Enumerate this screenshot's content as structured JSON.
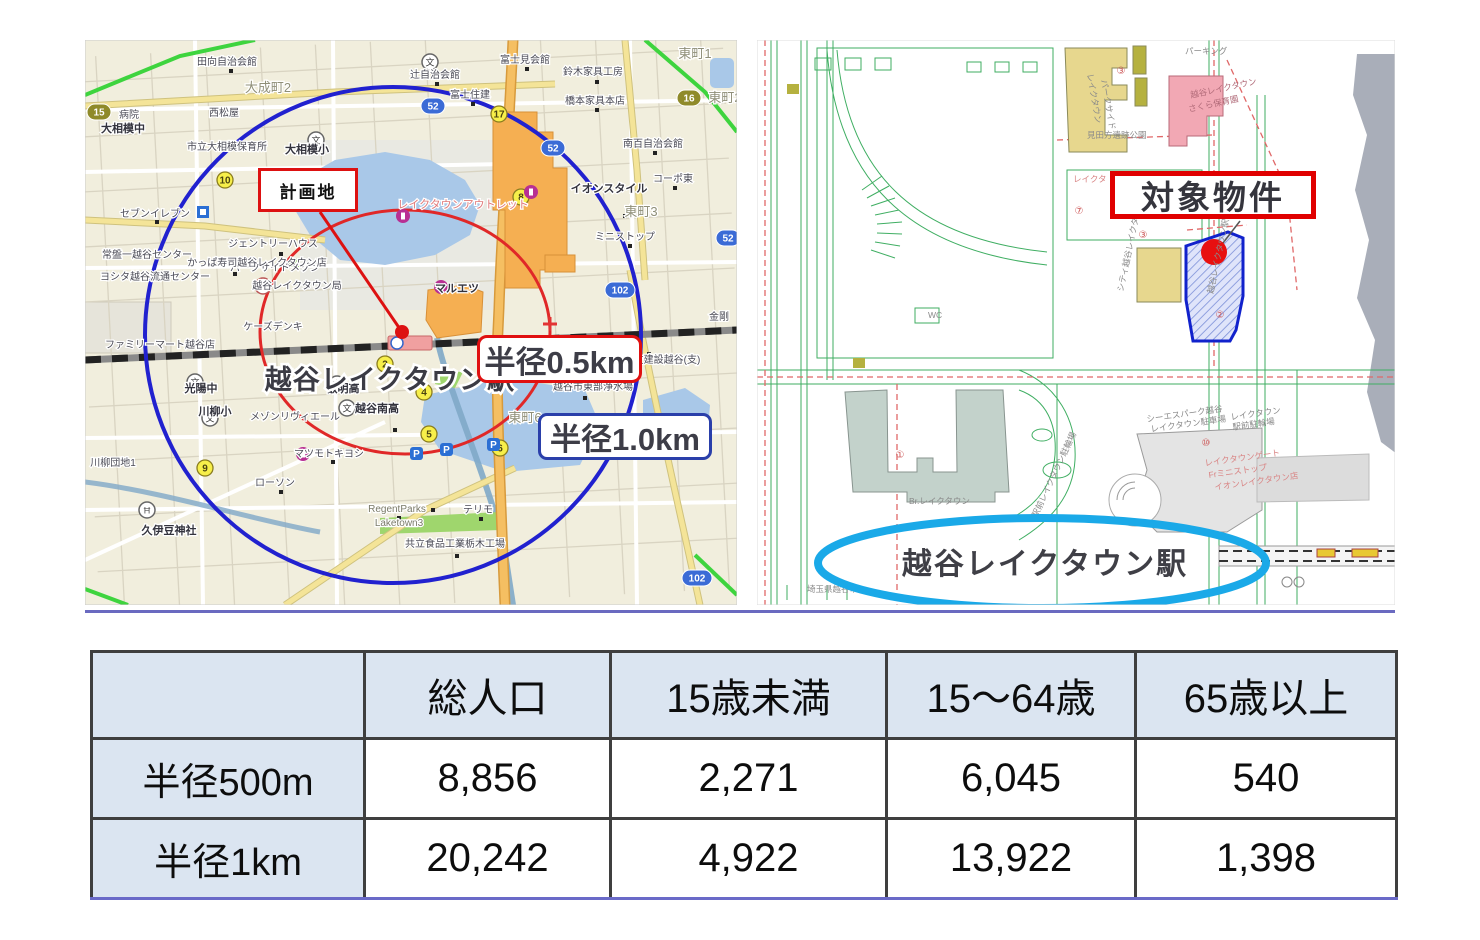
{
  "left_map": {
    "description": "radius map around planned site",
    "station_name": "越谷レイクタウン駅",
    "callouts": {
      "plan_site": "計画地",
      "radius_500m": "半径0.5km",
      "radius_1km": "半径1.0km"
    },
    "colors": {
      "circle_500m": "#e02828",
      "circle_1km": "#2121cf",
      "plan_box_border": "#dd1111",
      "radius_500m_border": "#e01010",
      "radius_1km_border": "#2a3faa",
      "map_background": "#f1eedd",
      "water": "#a9c8e8"
    },
    "labels": [
      {
        "t": "大相模中",
        "x": 38,
        "y": 92,
        "c": "m"
      },
      {
        "t": "田向自治会館",
        "x": 142,
        "y": 25,
        "c": "s"
      },
      {
        "t": "大成町2",
        "x": 183,
        "y": 52,
        "c": "area"
      },
      {
        "t": "市立大相模保育所",
        "x": 142,
        "y": 110,
        "c": "s"
      },
      {
        "t": "大相模小",
        "x": 222,
        "y": 113,
        "c": "m"
      },
      {
        "t": "西松屋",
        "x": 139,
        "y": 76,
        "c": "s"
      },
      {
        "t": "辻自治会館",
        "x": 350,
        "y": 38,
        "c": "s"
      },
      {
        "t": "富士見会館",
        "x": 440,
        "y": 23,
        "c": "s"
      },
      {
        "t": "鈴木家具工房",
        "x": 508,
        "y": 35,
        "c": "s"
      },
      {
        "t": "橋本家具本店",
        "x": 510,
        "y": 64,
        "c": "s"
      },
      {
        "t": "東町1",
        "x": 610,
        "y": 18,
        "c": "area"
      },
      {
        "t": "東町2",
        "x": 640,
        "y": 62,
        "c": "area"
      },
      {
        "t": "富士住建",
        "x": 385,
        "y": 58,
        "c": "s"
      },
      {
        "t": "病院",
        "x": 44,
        "y": 78,
        "c": "s"
      },
      {
        "t": "セブンイレブン",
        "x": 70,
        "y": 177,
        "c": "s"
      },
      {
        "t": "グラシア",
        "x": 212,
        "y": 152,
        "c": "s"
      },
      {
        "t": "南百自治会館",
        "x": 568,
        "y": 107,
        "c": "s"
      },
      {
        "t": "コーポ東",
        "x": 588,
        "y": 142,
        "c": "s"
      },
      {
        "t": "東町3",
        "x": 556,
        "y": 176,
        "c": "area"
      },
      {
        "t": "ミニストップ",
        "x": 540,
        "y": 200,
        "c": "s"
      },
      {
        "t": "イオンスタイル",
        "x": 524,
        "y": 152,
        "c": "m"
      },
      {
        "t": "レイクタウンアウトレット",
        "x": 378,
        "y": 168,
        "c": "red"
      },
      {
        "t": "ジェントリーハウス",
        "x": 188,
        "y": 207,
        "c": "s"
      },
      {
        "t": "パークサイドメゾン",
        "x": 190,
        "y": 231,
        "c": "s"
      },
      {
        "t": "常盤一越谷センター",
        "x": 62,
        "y": 218,
        "c": "s"
      },
      {
        "t": "ヨシタ越谷流通センター",
        "x": 70,
        "y": 240,
        "c": "s"
      },
      {
        "t": "かっぱ寿司越谷レイクタウン店",
        "x": 172,
        "y": 226,
        "c": "s"
      },
      {
        "t": "越谷レイクタウン局",
        "x": 212,
        "y": 249,
        "c": "s"
      },
      {
        "t": "ケーズデンキ",
        "x": 188,
        "y": 290,
        "c": "s"
      },
      {
        "t": "ファミリーマート越谷店",
        "x": 75,
        "y": 308,
        "c": "s"
      },
      {
        "t": "マルエツ",
        "x": 372,
        "y": 252,
        "c": "m"
      },
      {
        "t": "東町6",
        "x": 440,
        "y": 382,
        "c": "area"
      },
      {
        "t": "大友建設越谷(支)",
        "x": 577,
        "y": 323,
        "c": "s"
      },
      {
        "t": "越谷市東部浄水場",
        "x": 508,
        "y": 350,
        "c": "s"
      },
      {
        "t": "金剛",
        "x": 634,
        "y": 280,
        "c": "s"
      },
      {
        "t": "光陽中",
        "x": 116,
        "y": 352,
        "c": "m"
      },
      {
        "t": "川柳小",
        "x": 130,
        "y": 375,
        "c": "m"
      },
      {
        "t": "叡明高",
        "x": 258,
        "y": 352,
        "c": "m"
      },
      {
        "t": "越谷南高",
        "x": 292,
        "y": 372,
        "c": "m"
      },
      {
        "t": "メゾンリヴィエール",
        "x": 210,
        "y": 380,
        "c": "s"
      },
      {
        "t": "マツモトキヨシ",
        "x": 244,
        "y": 417,
        "c": "s"
      },
      {
        "t": "ローソン",
        "x": 190,
        "y": 446,
        "c": "s"
      },
      {
        "t": "川柳団地1",
        "x": 28,
        "y": 426,
        "c": "s"
      },
      {
        "t": "久伊豆神社",
        "x": 84,
        "y": 494,
        "c": "m"
      },
      {
        "t": "RegentParks",
        "x": 312,
        "y": 472,
        "c": "en"
      },
      {
        "t": "Laketown3",
        "x": 314,
        "y": 486,
        "c": "en"
      },
      {
        "t": "テリモ",
        "x": 393,
        "y": 473,
        "c": "s"
      },
      {
        "t": "共立食品工業栃木工場",
        "x": 370,
        "y": 507,
        "c": "s"
      }
    ],
    "shields": [
      {
        "n": "52",
        "x": 348,
        "y": 66,
        "k": "blue"
      },
      {
        "n": "52",
        "x": 468,
        "y": 108,
        "k": "blue"
      },
      {
        "n": "52",
        "x": 643,
        "y": 198,
        "k": "blue"
      },
      {
        "n": "102",
        "x": 535,
        "y": 250,
        "k": "blue"
      },
      {
        "n": "102",
        "x": 612,
        "y": 538,
        "k": "blue"
      },
      {
        "n": "16",
        "x": 604,
        "y": 58,
        "k": "olive"
      },
      {
        "n": "15",
        "x": 14,
        "y": 72,
        "k": "olive"
      }
    ],
    "badges": [
      {
        "n": "10",
        "x": 140,
        "y": 140
      },
      {
        "n": "17",
        "x": 414,
        "y": 74
      },
      {
        "n": "8",
        "x": 436,
        "y": 157
      },
      {
        "n": "9",
        "x": 120,
        "y": 428
      },
      {
        "n": "2",
        "x": 300,
        "y": 324
      },
      {
        "n": "4",
        "x": 339,
        "y": 352
      },
      {
        "n": "5",
        "x": 344,
        "y": 394
      },
      {
        "n": "6",
        "x": 415,
        "y": 408
      }
    ],
    "parking_marks": [
      {
        "x": 331,
        "y": 413
      },
      {
        "x": 361,
        "y": 409
      },
      {
        "x": 408,
        "y": 404
      }
    ],
    "icons": [
      {
        "k": "school",
        "x": 231,
        "y": 100
      },
      {
        "k": "school",
        "x": 345,
        "y": 22
      },
      {
        "k": "school",
        "x": 110,
        "y": 342
      },
      {
        "k": "school",
        "x": 125,
        "y": 378
      },
      {
        "k": "school",
        "x": 252,
        "y": 344
      },
      {
        "k": "school",
        "x": 262,
        "y": 368
      },
      {
        "k": "post",
        "x": 178,
        "y": 246
      },
      {
        "k": "shrine",
        "x": 62,
        "y": 470
      },
      {
        "k": "shop",
        "x": 356,
        "y": 247
      },
      {
        "k": "shop",
        "x": 446,
        "y": 152
      },
      {
        "k": "shop",
        "x": 318,
        "y": 176
      },
      {
        "k": "shop",
        "x": 218,
        "y": 414
      },
      {
        "k": "conv",
        "x": 118,
        "y": 172
      }
    ],
    "dots": [
      [
        38,
        84
      ],
      [
        146,
        31
      ],
      [
        352,
        44
      ],
      [
        442,
        29
      ],
      [
        512,
        42
      ],
      [
        512,
        70
      ],
      [
        388,
        64
      ],
      [
        72,
        182
      ],
      [
        214,
        158
      ],
      [
        570,
        113
      ],
      [
        590,
        148
      ],
      [
        545,
        206
      ],
      [
        150,
        234
      ],
      [
        564,
        314
      ],
      [
        500,
        358
      ],
      [
        310,
        390
      ],
      [
        196,
        452
      ],
      [
        314,
        478
      ],
      [
        396,
        479
      ],
      [
        372,
        516
      ],
      [
        248,
        422
      ],
      [
        540,
        176
      ],
      [
        196,
        214
      ],
      [
        348,
        470
      ]
    ]
  },
  "right_map": {
    "description": "cadastral site plan",
    "station_name": "越谷レイクタウン駅",
    "target_label": "対象物件",
    "colors": {
      "target_box_border": "#e00000",
      "property_outline": "#1122cc",
      "property_marker": "#e81010",
      "station_ellipse": "#1aa9e8"
    },
    "labels": [
      {
        "t": "パーキング",
        "x": 428,
        "y": 14,
        "c": "g"
      },
      {
        "t": "レイクタウン",
        "x": 330,
        "y": 34,
        "c": "g",
        "r": 80
      },
      {
        "t": "パークサイド",
        "x": 344,
        "y": 40,
        "c": "g",
        "r": 80
      },
      {
        "t": "越谷レイクタウン",
        "x": 434,
        "y": 58,
        "c": "pk",
        "r": -12
      },
      {
        "t": "さくら保育園",
        "x": 432,
        "y": 72,
        "c": "pk",
        "r": -12
      },
      {
        "t": "見田方遺跡公園",
        "x": 330,
        "y": 98,
        "c": "g"
      },
      {
        "t": "レイクタ",
        "x": 316,
        "y": 142,
        "c": "rd"
      },
      {
        "t": "WC",
        "x": 171,
        "y": 278,
        "c": "g"
      },
      {
        "t": "シティ越谷レイクタウン",
        "x": 366,
        "y": 252,
        "c": "g",
        "r": -78
      },
      {
        "t": "越谷レイクタウン駅前",
        "x": 456,
        "y": 254,
        "c": "g",
        "r": -78
      },
      {
        "t": "シーエスパーク越谷",
        "x": 390,
        "y": 382,
        "c": "g",
        "r": -8
      },
      {
        "t": "レイクタウン駐車場",
        "x": 394,
        "y": 392,
        "c": "g",
        "r": -8
      },
      {
        "t": "レイクタウン",
        "x": 474,
        "y": 380,
        "c": "g",
        "r": -8
      },
      {
        "t": "駅前駐輪場",
        "x": 476,
        "y": 390,
        "c": "g",
        "r": -8
      },
      {
        "t": "レイクタウンゲート",
        "x": 448,
        "y": 426,
        "c": "rd",
        "r": -8
      },
      {
        "t": "Frミニストップ",
        "x": 452,
        "y": 438,
        "c": "rd",
        "r": -8
      },
      {
        "t": "イオンレイクタウン店",
        "x": 458,
        "y": 450,
        "c": "rd",
        "r": -8
      },
      {
        "t": "Br.レイクタウン",
        "x": 152,
        "y": 464,
        "c": "g"
      },
      {
        "t": "駅前レイクタウン駐輪場",
        "x": 280,
        "y": 478,
        "c": "g",
        "r": -65
      },
      {
        "t": "埼玉県越谷市",
        "x": 50,
        "y": 552,
        "c": "g"
      }
    ],
    "red_numbers": [
      {
        "n": "③",
        "x": 364,
        "y": 34
      },
      {
        "n": "⑦",
        "x": 322,
        "y": 174
      },
      {
        "n": "③",
        "x": 386,
        "y": 198
      },
      {
        "n": "②",
        "x": 463,
        "y": 278
      },
      {
        "n": "①",
        "x": 143,
        "y": 418
      },
      {
        "n": "⑩",
        "x": 449,
        "y": 406
      }
    ]
  },
  "table": {
    "header": [
      "",
      "総人口",
      "15歳未満",
      "15〜64歳",
      "65歳以上"
    ],
    "rows": [
      {
        "label": "半径500m",
        "values": [
          "8,856",
          "2,271",
          "6,045",
          "540"
        ]
      },
      {
        "label": "半径1km",
        "values": [
          "20,242",
          "4,922",
          "13,922",
          "1,398"
        ]
      }
    ],
    "style": {
      "header_bg": "#dbe5f1",
      "border_color": "#3f3f3f",
      "bottom_line": "#6a6ac8"
    }
  }
}
